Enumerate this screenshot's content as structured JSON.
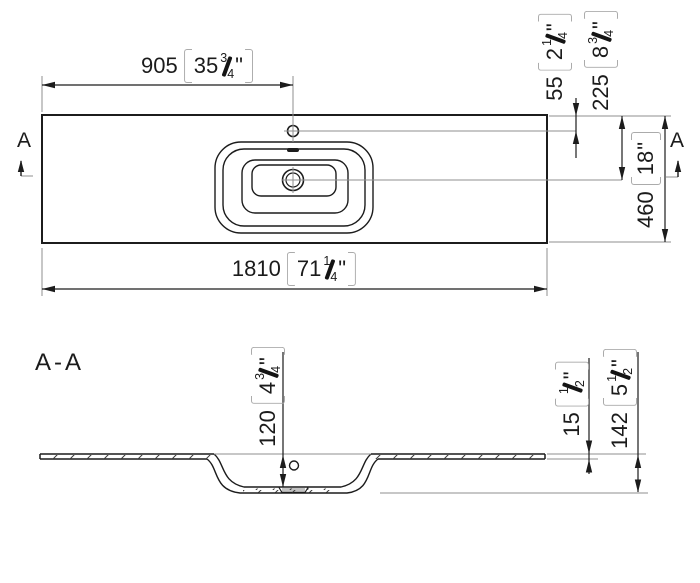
{
  "symbols": {
    "inch_mark": "\""
  },
  "top_view": {
    "cut_label_left": "A",
    "cut_label_right": "A",
    "dim_faucet_from_left": {
      "mm": "905",
      "in_whole": "35",
      "frac_num": "3",
      "frac_den": "4"
    },
    "dim_faucet_from_top_edge": {
      "mm": "55",
      "in_whole": "2",
      "frac_num": "1",
      "frac_den": "4"
    },
    "dim_drain_from_top_edge": {
      "mm": "225",
      "in_whole": "8",
      "frac_num": "3",
      "frac_den": "4"
    },
    "dim_depth": {
      "mm": "460",
      "in_whole": "18"
    },
    "dim_total_width": {
      "mm": "1810",
      "in_whole": "71",
      "frac_num": "1",
      "frac_den": "4"
    }
  },
  "section_view": {
    "title": "A-A",
    "dim_basin_depth": {
      "mm": "120",
      "in_whole": "4",
      "frac_num": "3",
      "frac_den": "4"
    },
    "dim_material_thickness": {
      "mm": "15",
      "frac_num": "1",
      "frac_den": "2"
    },
    "dim_total_height": {
      "mm": "142",
      "in_whole": "5",
      "frac_num": "1",
      "frac_den": "2"
    }
  },
  "colors": {
    "line": "#1c1c1c",
    "extension_line": "#8f8f8f",
    "bracket": "#ababab",
    "background": "#ffffff"
  }
}
